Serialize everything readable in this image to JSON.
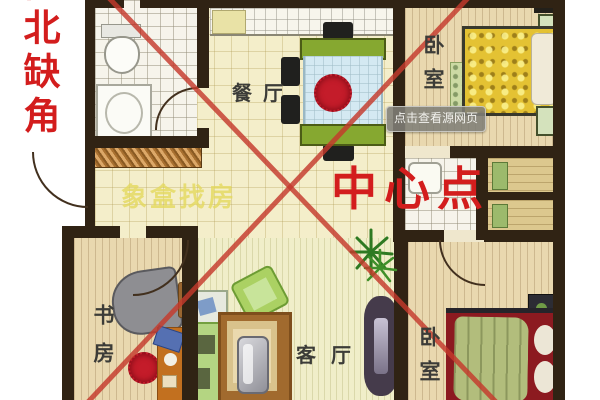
{
  "annotations": {
    "corner_note": "西北缺角",
    "center_point": "中心点",
    "watermark": "象盒找房",
    "tooltip": "点击查看源网页"
  },
  "rooms": {
    "dining": {
      "label": "餐厅"
    },
    "bedroom_ne": {
      "label": "卧室"
    },
    "bedroom_se": {
      "label": "卧室"
    },
    "study": {
      "label": "书房"
    },
    "living": {
      "label": "客厅"
    }
  },
  "colors": {
    "annotation_red": "#d31d1d",
    "line_red": "#c5392c",
    "wall_dark": "#302314",
    "watermark_yellow": "rgba(228,216,92,0.8)"
  }
}
